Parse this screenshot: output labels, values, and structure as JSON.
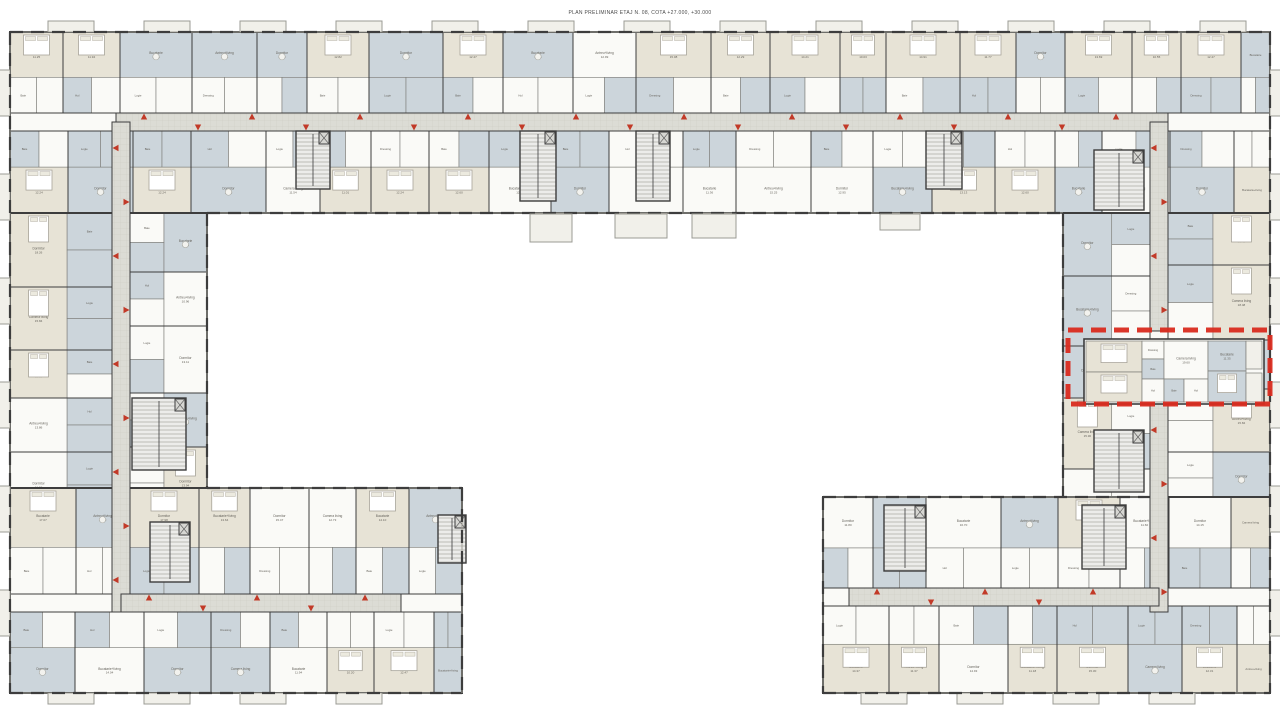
{
  "title": "PLAN PRELIMINAR ETAJ N. 08, COTA +27.000, +30.000",
  "colors": {
    "bg": "#ffffff",
    "wall": "#3d3d3d",
    "wall_light": "#7d7d78",
    "room_beige": "#e7e3d6",
    "room_blue": "#ccd5db",
    "room_white": "#fafaf7",
    "corridor": "#dcdcd5",
    "corridor_grid": "#cccbc3",
    "balcony": "#f1f0ea",
    "stair": "#ececea",
    "highlight_red": "#d92b1f",
    "arrow_red": "#c23a28",
    "label": "#66635c"
  },
  "floorplan": {
    "label_pool": [
      "Dormitor",
      "Camera living",
      "Bucatarie",
      "Antreu+living",
      "Dormitor",
      "Bucatarie+living"
    ],
    "small_label_pool": [
      "Baie",
      "Hol",
      "Logie",
      "Dressing",
      "Baie",
      "Logie"
    ],
    "wings": [
      {
        "name": "wing-top",
        "x": 10,
        "y": 32,
        "w": 1260,
        "h": 181,
        "orient": "h",
        "corr": 113,
        "corrSize": 18
      },
      {
        "name": "wing-left",
        "x": 10,
        "y": 213,
        "w": 197,
        "h": 480,
        "orient": "v",
        "corr": 112,
        "corrSize": 18
      },
      {
        "name": "wing-right",
        "x": 1063,
        "y": 213,
        "w": 207,
        "h": 480,
        "orient": "v",
        "corr": 1150,
        "corrSize": 18
      },
      {
        "name": "wing-bottom-left",
        "x": 10,
        "y": 488,
        "w": 452,
        "h": 205,
        "orient": "h",
        "corr": 594,
        "corrSize": 18
      },
      {
        "name": "wing-bottom-right",
        "x": 823,
        "y": 497,
        "w": 447,
        "h": 196,
        "orient": "h",
        "corr": 588,
        "corrSize": 18
      }
    ],
    "corridors": [
      {
        "name": "corridor-top",
        "x": 116,
        "y": 113,
        "w": 1052,
        "h": 18,
        "orient": "h"
      },
      {
        "name": "corridor-left",
        "x": 112,
        "y": 122,
        "w": 18,
        "h": 490,
        "orient": "v"
      },
      {
        "name": "corridor-right-upper",
        "x": 1150,
        "y": 122,
        "w": 18,
        "h": 209,
        "orient": "v"
      },
      {
        "name": "corridor-right-lower",
        "x": 1150,
        "y": 404,
        "w": 18,
        "h": 208,
        "orient": "v"
      },
      {
        "name": "corridor-bottom-left",
        "x": 121,
        "y": 594,
        "w": 280,
        "h": 18,
        "orient": "h"
      },
      {
        "name": "corridor-bottom-right",
        "x": 849,
        "y": 588,
        "w": 310,
        "h": 18,
        "orient": "h"
      }
    ],
    "stair_cores": [
      {
        "x": 296,
        "y": 131,
        "w": 34,
        "h": 58
      },
      {
        "x": 520,
        "y": 131,
        "w": 36,
        "h": 70
      },
      {
        "x": 636,
        "y": 131,
        "w": 34,
        "h": 70
      },
      {
        "x": 926,
        "y": 131,
        "w": 36,
        "h": 58
      },
      {
        "x": 132,
        "y": 398,
        "w": 54,
        "h": 72
      },
      {
        "x": 150,
        "y": 522,
        "w": 40,
        "h": 60
      },
      {
        "x": 438,
        "y": 515,
        "w": 28,
        "h": 48
      },
      {
        "x": 1094,
        "y": 150,
        "w": 50,
        "h": 60
      },
      {
        "x": 1094,
        "y": 430,
        "w": 50,
        "h": 62
      },
      {
        "x": 884,
        "y": 505,
        "w": 42,
        "h": 66
      },
      {
        "x": 1082,
        "y": 505,
        "w": 44,
        "h": 64
      }
    ],
    "inner_balconies": [
      {
        "x": 530,
        "y": 214,
        "w": 42,
        "h": 28
      },
      {
        "x": 615,
        "y": 214,
        "w": 52,
        "h": 24
      },
      {
        "x": 692,
        "y": 214,
        "w": 44,
        "h": 24
      },
      {
        "x": 880,
        "y": 214,
        "w": 40,
        "h": 16
      }
    ],
    "highlight": {
      "x": 1068,
      "y": 330,
      "w": 202,
      "h": 74
    },
    "selected_unit": {
      "rooms": [
        {
          "label": "Dormitor",
          "area": "14.05",
          "x": 1086,
          "y": 341,
          "w": 56,
          "h": 31,
          "fill": "beige",
          "bed": true
        },
        {
          "label": "Dormitor",
          "area": "14.26",
          "x": 1086,
          "y": 372,
          "w": 56,
          "h": 30,
          "fill": "beige",
          "bed": true
        },
        {
          "label": "Dressing",
          "area": "3.12",
          "x": 1142,
          "y": 341,
          "w": 22,
          "h": 18,
          "fill": "white"
        },
        {
          "label": "Baie",
          "area": "4.21",
          "x": 1142,
          "y": 359,
          "w": 22,
          "h": 20,
          "fill": "blue"
        },
        {
          "label": "Hol",
          "area": "6.40",
          "x": 1142,
          "y": 379,
          "w": 22,
          "h": 23,
          "fill": "white"
        },
        {
          "label": "Camera living",
          "area": "19.60",
          "x": 1164,
          "y": 341,
          "w": 44,
          "h": 38,
          "fill": "white"
        },
        {
          "label": "Baie",
          "area": "4.05",
          "x": 1164,
          "y": 379,
          "w": 20,
          "h": 23,
          "fill": "blue"
        },
        {
          "label": "Hol",
          "area": "5.10",
          "x": 1184,
          "y": 379,
          "w": 24,
          "h": 23,
          "fill": "white"
        },
        {
          "label": "Bucatarie",
          "area": "11.35",
          "x": 1208,
          "y": 341,
          "w": 38,
          "h": 30,
          "fill": "blue"
        },
        {
          "label": "Dormitor",
          "area": "13.80",
          "x": 1208,
          "y": 371,
          "w": 38,
          "h": 31,
          "fill": "blue",
          "bed": true
        },
        {
          "label": "Logie",
          "area": "2.75",
          "x": 1246,
          "y": 341,
          "w": 16,
          "h": 28,
          "fill": "balcony"
        },
        {
          "label": "Logie",
          "area": "2.60",
          "x": 1246,
          "y": 373,
          "w": 16,
          "h": 29,
          "fill": "balcony"
        }
      ]
    }
  }
}
